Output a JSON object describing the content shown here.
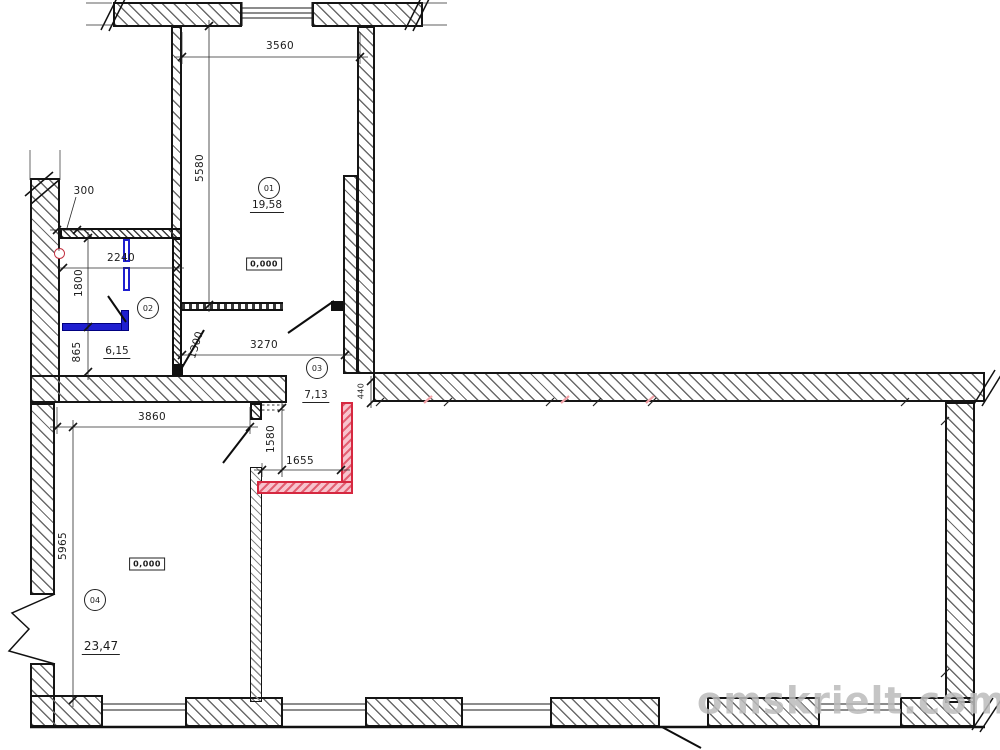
{
  "watermark": {
    "text": "omskrielt.com"
  },
  "rooms": [
    {
      "number": "01",
      "area": "19,58"
    },
    {
      "number": "02",
      "area": "6,15"
    },
    {
      "number": "03",
      "area": "7,13"
    },
    {
      "number": "04",
      "area": "23,47"
    }
  ],
  "elevations": [
    {
      "room": "01",
      "value": "0,000"
    },
    {
      "room": "04",
      "value": "0,000"
    }
  ],
  "dimensions": {
    "top_width": "3560",
    "room01_height": "5580",
    "wall_offset": "300",
    "room02_width": "2240",
    "room02_height_upper": "1800",
    "room02_height_lower": "865",
    "door_width": "1300",
    "corridor_width": "3270",
    "opening_width": "440",
    "room04_width": "3860",
    "niche_height": "1580",
    "niche_width": "1655",
    "room04_height": "5965"
  },
  "legend_colors": {
    "new_wall_red": "#d62840",
    "new_element_blue": "#1f1fd0",
    "drawing_line": "#1a1a1a",
    "watermark_gray": "#bcbcbc"
  }
}
